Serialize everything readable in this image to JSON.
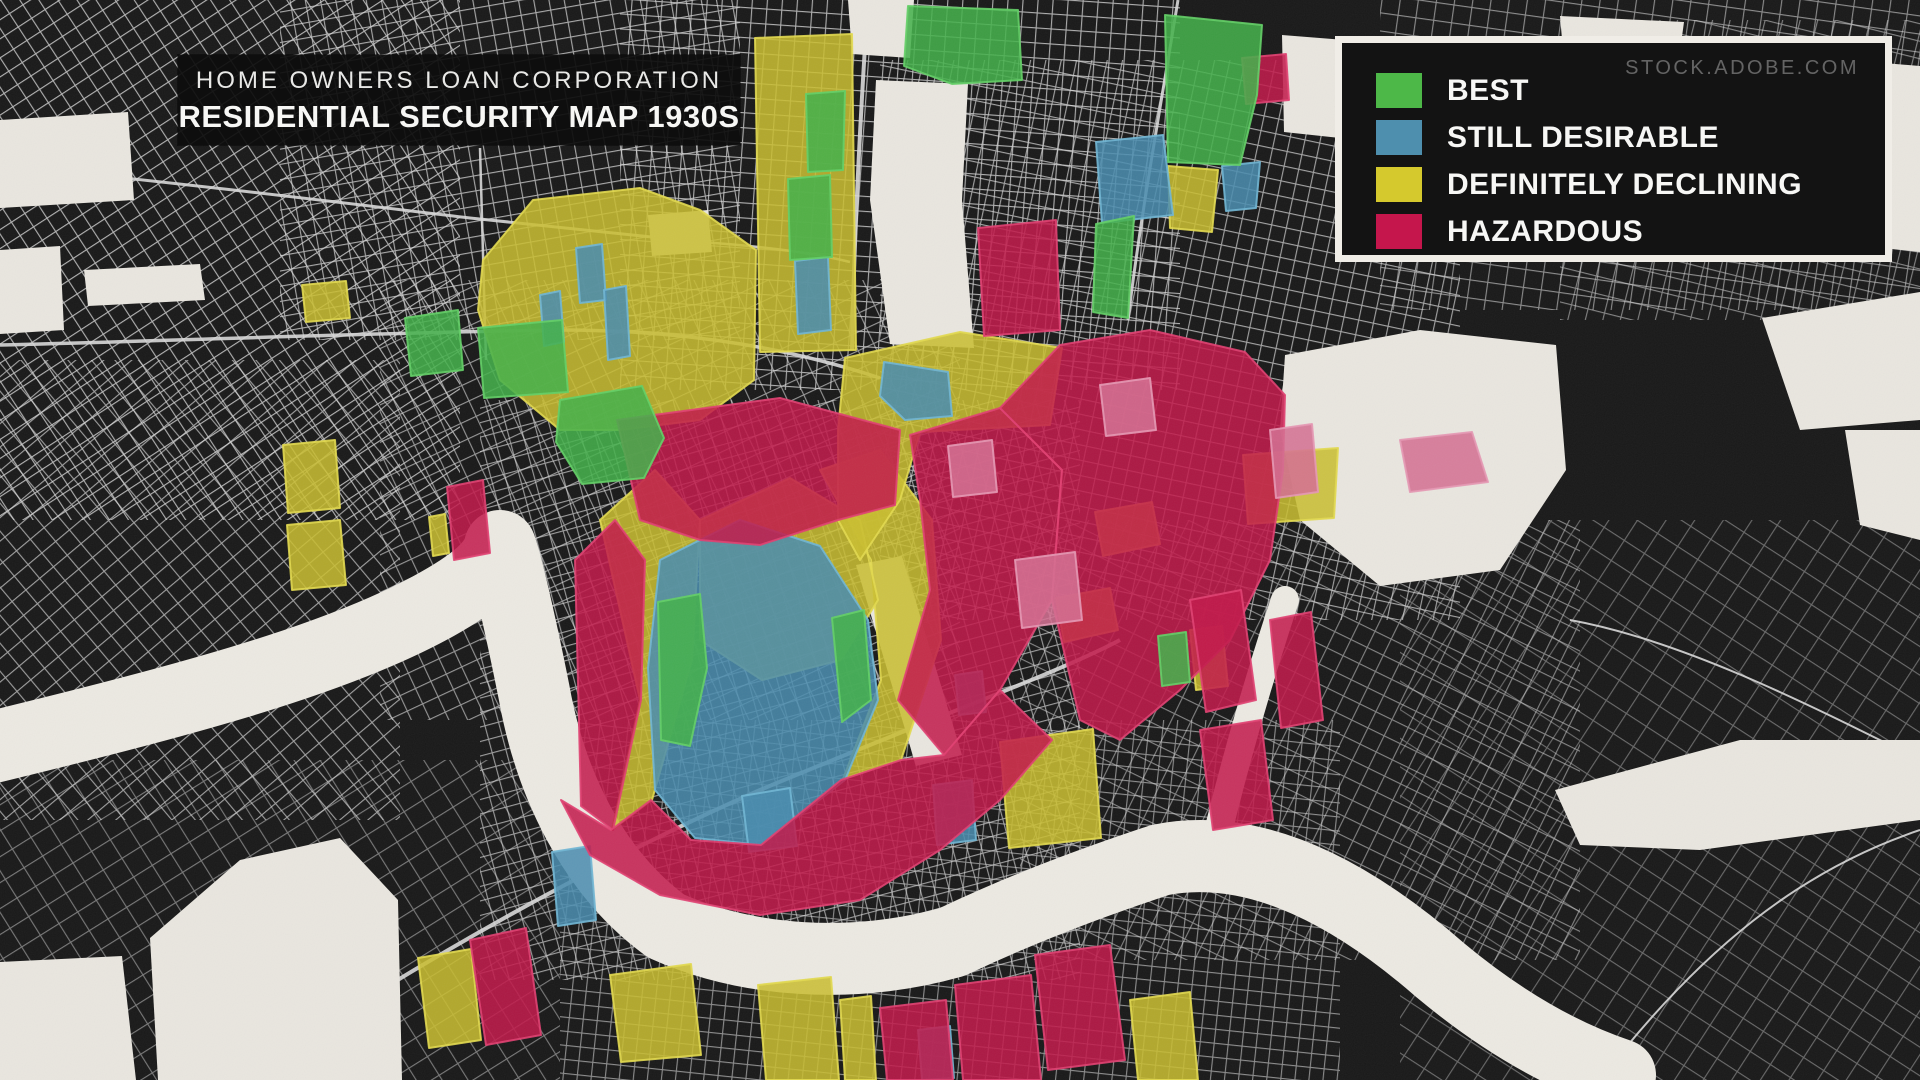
{
  "title": {
    "line1": "HOME OWNERS LOAN CORPORATION",
    "line2": "RESIDENTIAL SECURITY MAP 1930S"
  },
  "watermark": "STOCK.ADOBE.COM",
  "legend": {
    "items": [
      {
        "grade": "A",
        "label": "BEST",
        "color": "#4db848"
      },
      {
        "grade": "B",
        "label": "STILL DESIRABLE",
        "color": "#4e8fae"
      },
      {
        "grade": "C",
        "label": "DEFINITELY DECLINING",
        "color": "#d5c92d"
      },
      {
        "grade": "D",
        "label": "HAZARDOUS",
        "color": "#c5164c"
      }
    ]
  },
  "map": {
    "colors": {
      "background": "#191919",
      "street": "#d9d9d9",
      "paper": "#e9e6df",
      "water": "#ece9e2"
    },
    "grades": {
      "A": {
        "label": "BEST",
        "fill": "#44b14b",
        "stroke": "#63cf66"
      },
      "B": {
        "label": "STILL DESIRABLE",
        "fill": "#4a8caf",
        "stroke": "#70b6d4"
      },
      "C": {
        "label": "DEFINITELY DECLINING",
        "fill": "#c9bd30",
        "stroke": "#e2d94f"
      },
      "D": {
        "label": "HAZARDOUS",
        "fill": "#c2194b",
        "stroke": "#e04071"
      },
      "P": {
        "label": "HAZARDOUS",
        "fill": "#d46f92",
        "stroke": "#e698b4"
      }
    },
    "street_patches": [
      {
        "x": -40,
        "y": -40,
        "w": 500,
        "h": 560,
        "rot": -33,
        "cell": 16,
        "op": 0.8
      },
      {
        "x": 0,
        "y": 360,
        "w": 400,
        "h": 460,
        "rot": -40,
        "cell": 18,
        "op": 0.7
      },
      {
        "x": 280,
        "y": -20,
        "w": 460,
        "h": 360,
        "rot": -10,
        "cell": 15,
        "op": 0.75
      },
      {
        "x": 620,
        "y": -30,
        "w": 560,
        "h": 420,
        "rot": 4,
        "cell": 15,
        "op": 0.78
      },
      {
        "x": 380,
        "y": 280,
        "w": 580,
        "h": 440,
        "rot": -25,
        "cell": 17,
        "op": 0.65
      },
      {
        "x": 880,
        "y": 60,
        "w": 580,
        "h": 560,
        "rot": 12,
        "cell": 15,
        "op": 0.72
      },
      {
        "x": 1380,
        "y": -20,
        "w": 560,
        "h": 330,
        "rot": 8,
        "cell": 18,
        "op": 0.6
      },
      {
        "x": 1020,
        "y": 520,
        "w": 560,
        "h": 440,
        "rot": 26,
        "cell": 18,
        "op": 0.55
      },
      {
        "x": 480,
        "y": 400,
        "w": 600,
        "h": 580,
        "rot": -15,
        "cell": 14,
        "op": 0.68
      },
      {
        "x": -20,
        "y": 760,
        "w": 580,
        "h": 340,
        "rot": -32,
        "cell": 22,
        "op": 0.5
      },
      {
        "x": 1400,
        "y": 520,
        "w": 540,
        "h": 580,
        "rot": 33,
        "cell": 24,
        "op": 0.42
      },
      {
        "x": 560,
        "y": 720,
        "w": 780,
        "h": 370,
        "rot": 6,
        "cell": 14,
        "op": 0.6
      },
      {
        "x": 1560,
        "y": 20,
        "w": 380,
        "h": 300,
        "rot": 14,
        "cell": 17,
        "op": 0.55
      }
    ],
    "roads": [
      {
        "d": "M0,165 C200,185 360,205 470,218 C560,228 640,236 700,242",
        "w": 3
      },
      {
        "d": "M0,345 C200,340 400,332 560,330 C700,330 800,352 880,378",
        "w": 3.5
      },
      {
        "d": "M868,0 C860,120 854,240 852,350",
        "w": 4
      },
      {
        "d": "M1178,0 C1160,110 1140,220 1128,320",
        "w": 3
      },
      {
        "d": "M240,1080 C420,960 600,860 760,790 C940,715 1060,672 1120,640",
        "w": 4
      },
      {
        "d": "M480,148 L486,360",
        "w": 2.5
      },
      {
        "d": "M1570,620 C1680,640 1800,700 1920,760",
        "w": 2
      },
      {
        "d": "M1600,1080 C1700,950 1800,870 1920,830",
        "w": 2
      },
      {
        "d": "M700,242 C760,246 810,252 850,262",
        "w": 2.5
      }
    ],
    "white_areas": [
      "0,120 128,112 134,200 0,208",
      "0,250 60,246 64,330 0,334",
      "84,270 200,264 205,300 88,306",
      "648,215 708,210 712,252 652,256",
      "848,0 914,0 910,58 852,54",
      "876,80 968,84 962,200 974,348 890,344 870,200",
      "1282,35 1345,40 1340,138 1284,132",
      "1285,355 1420,330 1556,345 1566,470 1500,570 1380,586 1300,520 1280,430",
      "1598,78 1800,90 1790,255 1620,242",
      "1848,60 1920,66 1920,252 1855,245",
      "1560,16 1684,22 1678,66 1564,62",
      "1762,318 1920,292 1920,420 1800,430",
      "1845,430 1920,430 1920,540 1860,525",
      "0,962 122,956 136,1080 0,1080",
      "150,938 240,860 340,838 398,900 402,1080 158,1080",
      "856,565 902,556 962,755 916,766",
      "1555,790 1740,740 1920,740 1920,820 1700,850 1580,845"
    ],
    "river": {
      "d": "M-40,755 C180,702 330,662 430,608 C478,582 496,564 500,546 C506,562 520,622 534,692 C550,782 592,872 666,926 C746,962 852,970 952,942 C1030,905 1100,880 1160,860 C1260,840 1360,900 1440,970 C1500,1020 1560,1055 1620,1075",
      "width": 72
    },
    "canal": {
      "d": "M1210,865 C1230,780 1255,690 1285,600",
      "width": 28
    },
    "zones": [
      {
        "g": "C",
        "p": "755,38 852,34 856,350 760,352"
      },
      {
        "g": "C",
        "p": "483,260 533,200 640,188 700,210 756,250 754,380 700,420 620,430 560,430 500,380 478,310"
      },
      {
        "g": "C",
        "p": "302,285 346,281 350,318 306,322"
      },
      {
        "g": "C",
        "p": "283,445 335,440 340,508 288,513"
      },
      {
        "g": "C",
        "p": "287,525 340,520 346,585 292,590"
      },
      {
        "g": "C",
        "p": "600,520 655,470 700,520 692,660 652,800 612,830 640,700"
      },
      {
        "g": "C",
        "p": "820,470 880,450 932,520 941,640 901,760 843,779 881,680 871,560"
      },
      {
        "g": "C",
        "p": "700,520 790,478 860,520 878,600 841,660 762,680 700,640"
      },
      {
        "g": "C",
        "p": "845,358 960,332 1062,348 1050,425 920,432 900,500 860,560 838,520 838,430"
      },
      {
        "g": "C",
        "p": "1095,512 1152,502 1160,544 1103,556"
      },
      {
        "g": "C",
        "p": "1056,598 1110,588 1118,630 1064,642"
      },
      {
        "g": "C",
        "p": "1168,166 1218,170 1212,232 1170,228"
      },
      {
        "g": "C",
        "p": "1243,455 1338,448 1334,518 1248,524"
      },
      {
        "g": "C",
        "p": "1000,742 1093,729 1101,838 1009,848"
      },
      {
        "g": "C",
        "p": "610,975 691,964 701,1055 621,1062"
      },
      {
        "g": "C",
        "p": "758,985 831,977 839,1080 766,1080"
      },
      {
        "g": "C",
        "p": "418,958 471,949 481,1040 429,1048"
      },
      {
        "g": "C",
        "p": "1130,1000 1190,992 1198,1080 1138,1080"
      },
      {
        "g": "C",
        "p": "840,1000 871,996 876,1080 845,1080"
      },
      {
        "g": "C",
        "p": "429,517 445,514 449,553 433,556"
      },
      {
        "g": "C",
        "p": "1190,630 1222,626 1228,686 1196,690"
      },
      {
        "g": "B",
        "p": "540,295 560,291 564,342 544,346"
      },
      {
        "g": "B",
        "p": "795,261 828,257 831,330 798,334"
      },
      {
        "g": "B",
        "p": "1096,142 1163,135 1173,215 1102,223"
      },
      {
        "g": "B",
        "p": "1222,166 1260,162 1256,208 1226,211"
      },
      {
        "g": "B",
        "p": "884,362 948,372 952,416 905,420 880,396"
      },
      {
        "g": "B",
        "p": "660,560 740,520 820,546 868,620 878,700 845,780 762,845 695,838 655,790 648,668"
      },
      {
        "g": "B",
        "p": "742,796 790,788 797,846 749,852"
      },
      {
        "g": "B",
        "p": "576,248 602,244 606,300 580,303"
      },
      {
        "g": "B",
        "p": "604,290 626,286 630,356 608,360"
      },
      {
        "g": "B",
        "p": "918,1030 950,1026 954,1078 922,1080"
      },
      {
        "g": "B",
        "p": "552,852 590,846 596,920 558,926"
      },
      {
        "g": "B",
        "p": "933,785 972,780 976,840 937,845"
      },
      {
        "g": "B",
        "p": "955,675 982,671 986,712 959,715"
      },
      {
        "g": "D",
        "p": "617,420 780,398 900,430 895,505 838,520 760,545 700,540 640,520"
      },
      {
        "g": "D",
        "p": "575,560 615,520 645,560 641,700 613,830 581,806"
      },
      {
        "g": "D",
        "p": "910,435 1000,408 1062,470 1052,600 1000,690 944,755 898,700 930,590 920,500"
      },
      {
        "g": "D",
        "p": "1060,345 1150,330 1245,352 1285,395 1283,470 1270,560 1230,640 1180,690 1120,740 1080,720 1052,600 1062,470 1000,408"
      },
      {
        "g": "D",
        "p": "561,800 611,830 651,800 691,840 761,845 841,780 901,760 944,755 1000,690 1052,740 1000,800 940,850 860,900 760,915 660,895 590,855"
      },
      {
        "g": "D",
        "p": "978,228 1056,220 1060,330 984,336"
      },
      {
        "g": "D",
        "p": "1242,58 1286,54 1289,100 1246,104"
      },
      {
        "g": "D",
        "p": "1190,600 1241,590 1256,700 1206,712"
      },
      {
        "g": "D",
        "p": "1270,620 1311,612 1323,720 1281,728"
      },
      {
        "g": "D",
        "p": "1200,730 1261,720 1273,820 1213,830"
      },
      {
        "g": "D",
        "p": "470,940 526,928 541,1035 486,1045"
      },
      {
        "g": "D",
        "p": "880,1008 946,1000 953,1080 887,1080"
      },
      {
        "g": "D",
        "p": "955,985 1031,975 1041,1080 963,1080"
      },
      {
        "g": "D",
        "p": "1035,955 1110,945 1125,1060 1048,1070"
      },
      {
        "g": "D",
        "p": "447,487 483,480 490,553 454,560"
      },
      {
        "g": "P",
        "p": "1015,560 1075,552 1082,620 1022,628"
      },
      {
        "g": "P",
        "p": "948,446 992,440 997,492 953,497"
      },
      {
        "g": "P",
        "p": "1270,430 1312,424 1318,492 1276,498"
      },
      {
        "g": "P",
        "p": "1100,385 1150,378 1156,430 1106,436"
      },
      {
        "g": "P",
        "p": "1400,440 1472,432 1488,482 1410,492"
      },
      {
        "g": "A",
        "p": "908,6 1018,10 1022,80 952,84 904,66"
      },
      {
        "g": "A",
        "p": "560,400 642,386 664,438 644,478 582,484 556,442"
      },
      {
        "g": "A",
        "p": "658,602 700,594 707,668 690,746 661,740"
      },
      {
        "g": "A",
        "p": "832,618 864,610 871,700 842,722"
      },
      {
        "g": "A",
        "p": "405,318 458,310 463,370 411,376"
      },
      {
        "g": "A",
        "p": "478,328 562,320 568,392 484,398"
      },
      {
        "g": "A",
        "p": "1165,15 1262,25 1257,95 1240,165 1168,162"
      },
      {
        "g": "A",
        "p": "1096,224 1134,216 1128,318 1093,312"
      },
      {
        "g": "A",
        "p": "806,94 845,91 843,170 808,172"
      },
      {
        "g": "A",
        "p": "788,179 830,175 832,257 790,260"
      },
      {
        "g": "A",
        "p": "1158,636 1186,632 1190,682 1162,686"
      }
    ]
  }
}
